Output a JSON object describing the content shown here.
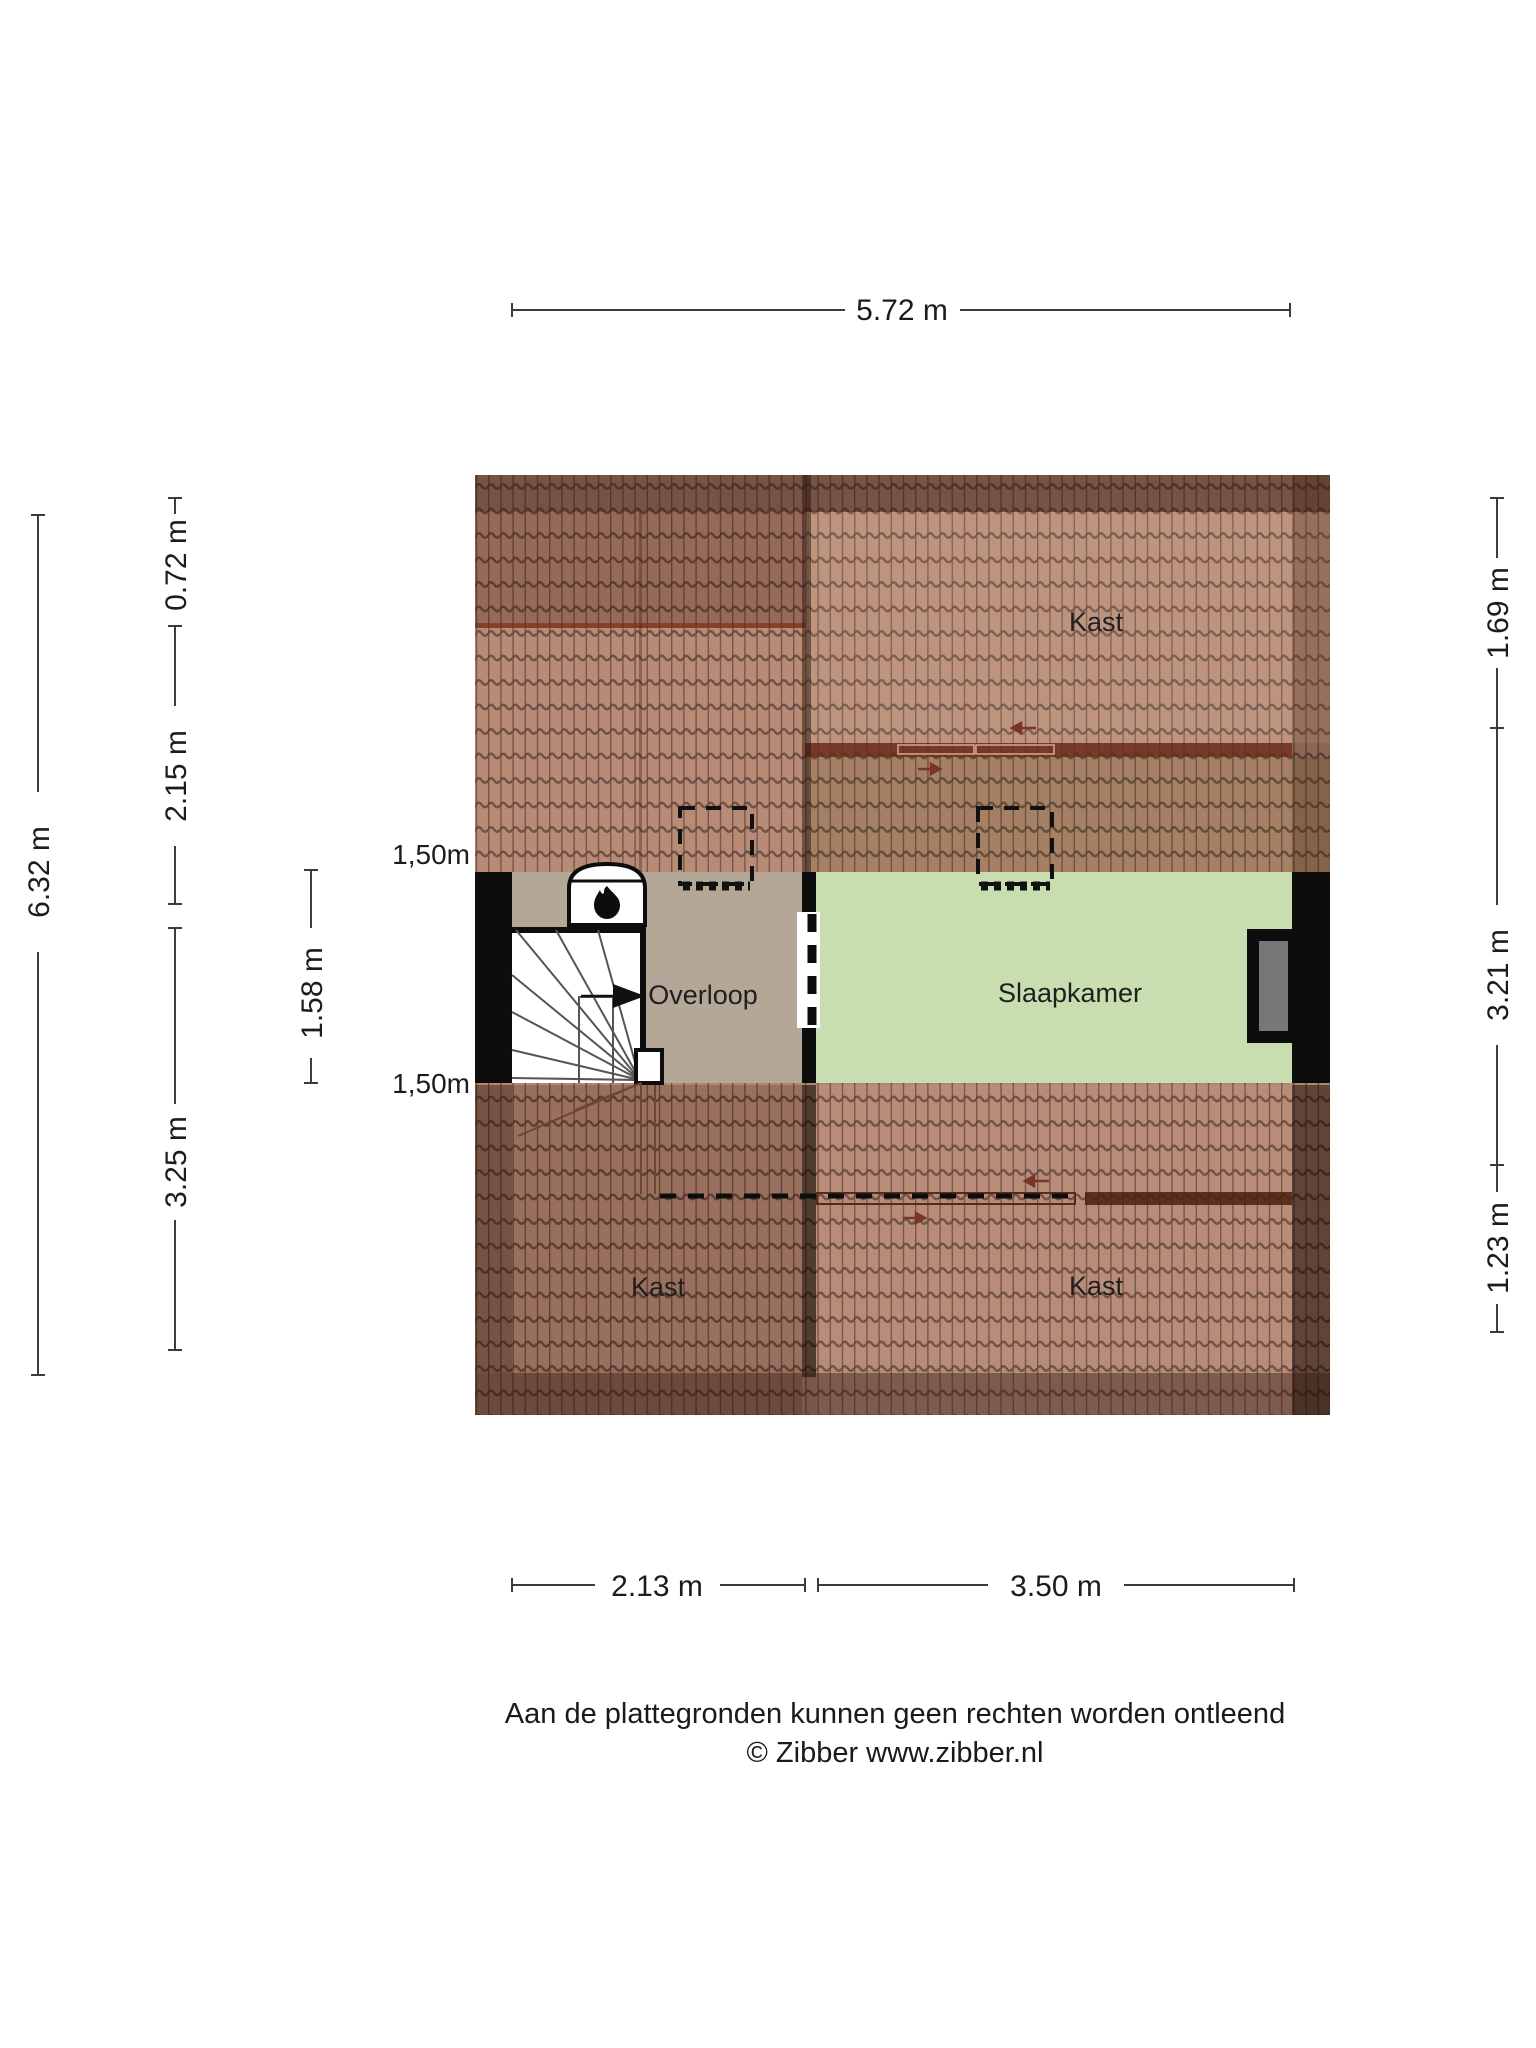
{
  "floorplan": {
    "type": "attic-floor-plan",
    "rooms": {
      "kast_top": "Kast",
      "kast_bottom_left": "Kast",
      "kast_bottom_right": "Kast",
      "overloop": "Overloop",
      "slaapkamer": "Slaapkamer"
    },
    "features": [
      "stairs",
      "wood-stove",
      "window",
      "door-opening",
      "skylight",
      "skylight"
    ]
  },
  "dimensions": {
    "top": "5.72 m",
    "left_outer": "6.32 m",
    "left_seg1": "0.72 m",
    "left_seg2": "2.15 m",
    "left_seg3": "3.25 m",
    "landing_depth": "1.58 m",
    "headroom_top": "1,50m",
    "headroom_bottom": "1,50m",
    "right_seg1": "1.69 m",
    "right_seg2": "3.21 m",
    "right_seg3": "1.23 m",
    "bottom_left": "2.13 m",
    "bottom_right": "3.50 m"
  },
  "footer": {
    "disclaimer": "Aan de plattegronden kunnen geen rechten worden ontleend",
    "copyright": "© Zibber www.zibber.nl"
  },
  "colors": {
    "roof_tile": "#b28672",
    "floor_landing": "#b5a797",
    "floor_bedroom": "#c8ddb0",
    "wall": "#0d0d0d",
    "window_glass": "#777777"
  }
}
